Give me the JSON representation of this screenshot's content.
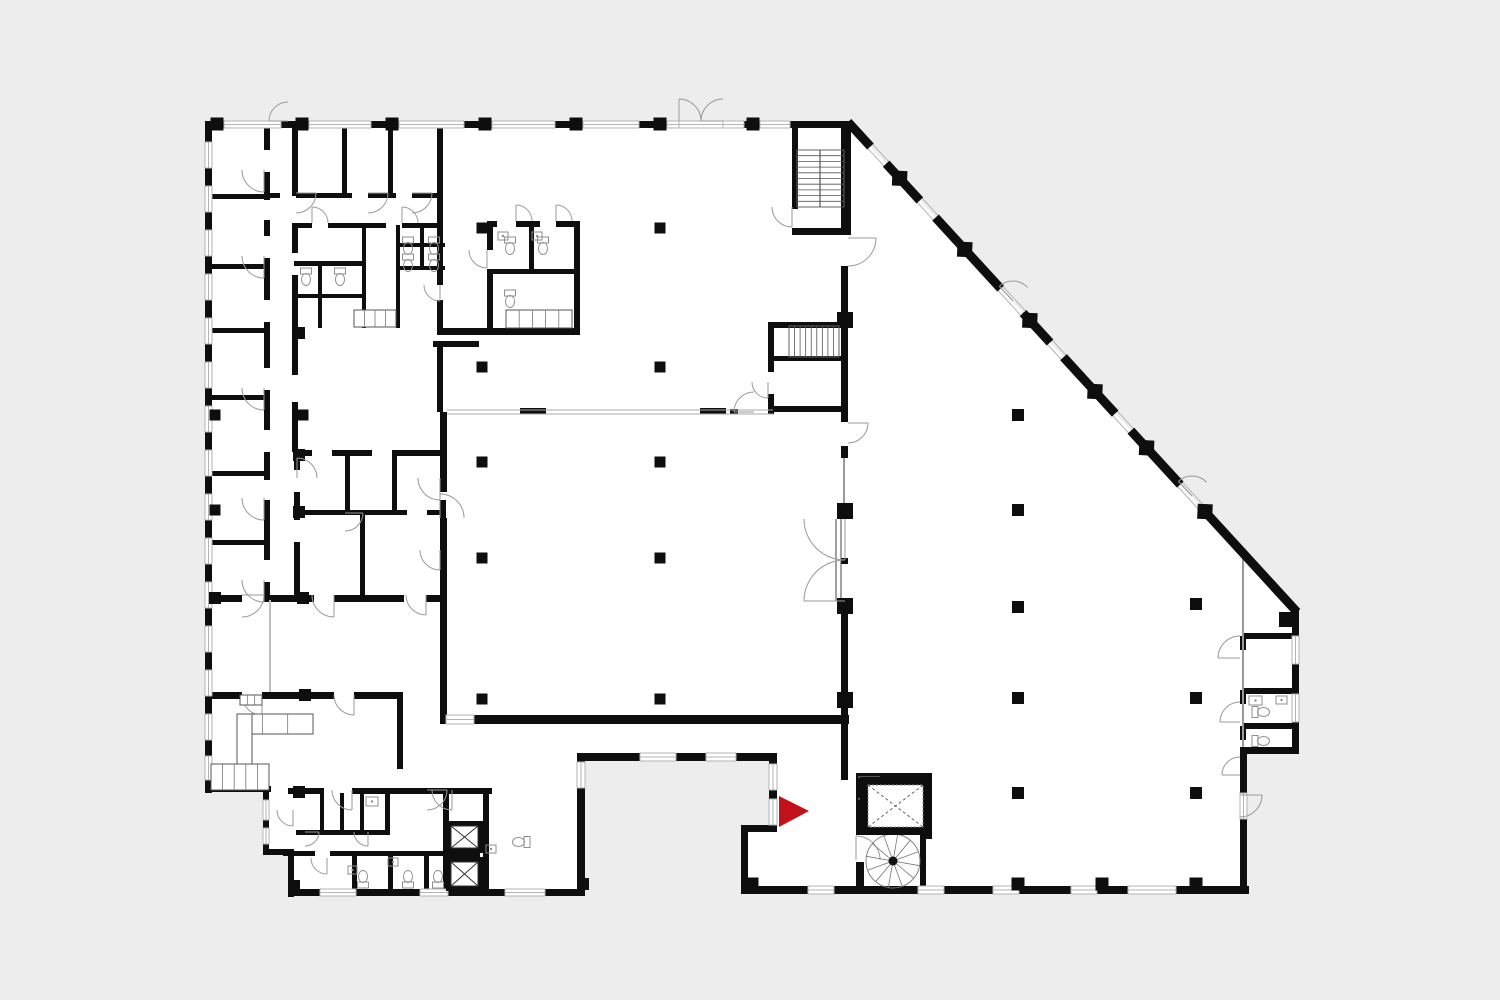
{
  "title": "building-floor-plan",
  "canvas": {
    "w": 1500,
    "h": 1000
  },
  "colors": {
    "bg": "#ededed",
    "floor": "#ffffff",
    "wall": "#0e0e0e",
    "thin": "#9a9a9a",
    "arc": "#9a9a9a",
    "fixture": "#8f8f8f",
    "window_edge": "#b3b3b3",
    "arrow": "#c1121c",
    "dash": "#666666"
  },
  "floor_outline": [
    [
      205,
      122
    ],
    [
      848,
      122
    ],
    [
      1297,
      612
    ],
    [
      1297,
      752
    ],
    [
      1247,
      752
    ],
    [
      1247,
      890
    ],
    [
      745,
      890
    ],
    [
      745,
      828
    ],
    [
      775,
      828
    ],
    [
      775,
      757
    ],
    [
      583,
      757
    ],
    [
      583,
      893
    ],
    [
      290,
      893
    ],
    [
      290,
      851
    ],
    [
      267,
      851
    ],
    [
      267,
      790
    ],
    [
      205,
      790
    ]
  ],
  "walls": [
    [
      205,
      121,
      645,
      7
    ],
    [
      205,
      121,
      7,
      672
    ],
    [
      205,
      786,
      66,
      6
    ],
    [
      263,
      786,
      6,
      69
    ],
    [
      263,
      849,
      31,
      6
    ],
    [
      288,
      849,
      6,
      48
    ],
    [
      288,
      889,
      297,
      7
    ],
    [
      577,
      753,
      8,
      142
    ],
    [
      577,
      753,
      200,
      8
    ],
    [
      769,
      753,
      8,
      79
    ],
    [
      741,
      825,
      36,
      7
    ],
    [
      741,
      825,
      7,
      68
    ],
    [
      741,
      886,
      508,
      8
    ],
    [
      1240,
      747,
      59,
      7
    ],
    [
      1240,
      747,
      7,
      147
    ],
    [
      1292,
      608,
      7,
      146
    ],
    [
      1243,
      633,
      52,
      6
    ],
    [
      1243,
      688,
      52,
      6
    ],
    [
      1243,
      723,
      52,
      6
    ],
    [
      1279,
      612,
      18,
      15
    ],
    [
      1240,
      636,
      6,
      14
    ],
    [
      1240,
      690,
      6,
      14
    ],
    [
      1240,
      726,
      6,
      14
    ],
    [
      841,
      121,
      10,
      112
    ],
    [
      841,
      266,
      7,
      52
    ],
    [
      841,
      326,
      7,
      86
    ],
    [
      841,
      412,
      7,
      10
    ],
    [
      841,
      446,
      7,
      12
    ],
    [
      841,
      558,
      7,
      6
    ],
    [
      841,
      612,
      7,
      148
    ],
    [
      841,
      760,
      7,
      20
    ],
    [
      792,
      121,
      6,
      88
    ],
    [
      792,
      228,
      59,
      7
    ],
    [
      768,
      322,
      77,
      6
    ],
    [
      768,
      322,
      6,
      50
    ],
    [
      768,
      356,
      77,
      5
    ],
    [
      768,
      394,
      6,
      20
    ],
    [
      768,
      406,
      77,
      6
    ],
    [
      520,
      408,
      26,
      6
    ],
    [
      700,
      408,
      26,
      6
    ],
    [
      730,
      409,
      8,
      5
    ],
    [
      440,
      412,
      7,
      80
    ],
    [
      440,
      518,
      7,
      204
    ],
    [
      440,
      715,
      409,
      9
    ],
    [
      437,
      127,
      6,
      133
    ],
    [
      437,
      260,
      6,
      25
    ],
    [
      437,
      300,
      6,
      30
    ],
    [
      433,
      341,
      46,
      6
    ],
    [
      437,
      341,
      6,
      71
    ],
    [
      437,
      328,
      143,
      7
    ],
    [
      487,
      221,
      10,
      6
    ],
    [
      516,
      221,
      24,
      6
    ],
    [
      556,
      221,
      24,
      6
    ],
    [
      487,
      221,
      6,
      29
    ],
    [
      487,
      270,
      6,
      60
    ],
    [
      574,
      221,
      6,
      109
    ],
    [
      487,
      269,
      93,
      5
    ],
    [
      529,
      221,
      5,
      48
    ],
    [
      264,
      121,
      6,
      29
    ],
    [
      264,
      172,
      6,
      28
    ],
    [
      264,
      220,
      6,
      16
    ],
    [
      264,
      258,
      6,
      42
    ],
    [
      264,
      322,
      6,
      46
    ],
    [
      264,
      390,
      6,
      40
    ],
    [
      264,
      452,
      6,
      28
    ],
    [
      264,
      500,
      6,
      60
    ],
    [
      264,
      582,
      6,
      16
    ],
    [
      292,
      121,
      6,
      75
    ],
    [
      292,
      223,
      6,
      30
    ],
    [
      292,
      275,
      6,
      55
    ],
    [
      292,
      330,
      6,
      45
    ],
    [
      292,
      402,
      6,
      50
    ],
    [
      342,
      127,
      5,
      68
    ],
    [
      388,
      127,
      5,
      68
    ],
    [
      267,
      193,
      13,
      5
    ],
    [
      296,
      193,
      56,
      5
    ],
    [
      368,
      193,
      28,
      5
    ],
    [
      412,
      193,
      28,
      5
    ],
    [
      294,
      223,
      18,
      5
    ],
    [
      328,
      223,
      58,
      5
    ],
    [
      402,
      223,
      38,
      5
    ],
    [
      318,
      261,
      4,
      67
    ],
    [
      294,
      261,
      72,
      5
    ],
    [
      294,
      294,
      72,
      4
    ],
    [
      362,
      225,
      4,
      103
    ],
    [
      396,
      225,
      4,
      103
    ],
    [
      396,
      243,
      49,
      4
    ],
    [
      396,
      266,
      49,
      4
    ],
    [
      420,
      225,
      4,
      42
    ],
    [
      205,
      194,
      62,
      5
    ],
    [
      205,
      264,
      62,
      5
    ],
    [
      205,
      328,
      62,
      5
    ],
    [
      205,
      395,
      62,
      5
    ],
    [
      205,
      471,
      62,
      5
    ],
    [
      205,
      540,
      62,
      5
    ],
    [
      205,
      595,
      37,
      7
    ],
    [
      264,
      595,
      50,
      7
    ],
    [
      334,
      595,
      70,
      7
    ],
    [
      426,
      595,
      19,
      7
    ],
    [
      294,
      450,
      18,
      6
    ],
    [
      332,
      450,
      40,
      6
    ],
    [
      392,
      450,
      53,
      6
    ],
    [
      440,
      450,
      6,
      26
    ],
    [
      440,
      500,
      6,
      30
    ],
    [
      440,
      552,
      6,
      45
    ],
    [
      294,
      452,
      6,
      18
    ],
    [
      294,
      492,
      6,
      28
    ],
    [
      294,
      542,
      6,
      55
    ],
    [
      345,
      452,
      5,
      60
    ],
    [
      392,
      452,
      5,
      60
    ],
    [
      294,
      510,
      113,
      5
    ],
    [
      427,
      510,
      18,
      5
    ],
    [
      360,
      515,
      5,
      82
    ],
    [
      205,
      692,
      37,
      7
    ],
    [
      262,
      692,
      72,
      7
    ],
    [
      354,
      692,
      49,
      7
    ],
    [
      397,
      692,
      6,
      77
    ],
    [
      288,
      788,
      36,
      6
    ],
    [
      352,
      788,
      95,
      6
    ],
    [
      443,
      788,
      49,
      6
    ],
    [
      320,
      793,
      4,
      39
    ],
    [
      340,
      793,
      4,
      39
    ],
    [
      360,
      793,
      4,
      39
    ],
    [
      385,
      793,
      5,
      39
    ],
    [
      296,
      830,
      94,
      5
    ],
    [
      283,
      851,
      32,
      5
    ],
    [
      330,
      851,
      117,
      5
    ],
    [
      352,
      856,
      5,
      37
    ],
    [
      388,
      856,
      5,
      37
    ],
    [
      424,
      856,
      5,
      37
    ],
    [
      443,
      788,
      6,
      105
    ],
    [
      483,
      788,
      6,
      105
    ],
    [
      449,
      852,
      31,
      5
    ],
    [
      856,
      773,
      8,
      62
    ],
    [
      856,
      862,
      8,
      31
    ],
    [
      856,
      773,
      76,
      8
    ],
    [
      926,
      773,
      6,
      66
    ],
    [
      920,
      833,
      6,
      57
    ]
  ],
  "windows": [
    [
      224,
      121,
      57,
      7
    ],
    [
      309,
      121,
      62,
      7
    ],
    [
      399,
      121,
      65,
      7
    ],
    [
      492,
      121,
      63,
      7
    ],
    [
      583,
      121,
      56,
      7
    ],
    [
      667,
      121,
      12,
      7
    ],
    [
      679,
      121,
      44,
      7
    ],
    [
      723,
      121,
      21,
      7
    ],
    [
      760,
      121,
      30,
      7
    ],
    [
      205,
      142,
      7,
      26
    ],
    [
      205,
      186,
      7,
      26
    ],
    [
      205,
      230,
      7,
      26
    ],
    [
      205,
      274,
      7,
      26
    ],
    [
      205,
      318,
      7,
      26
    ],
    [
      205,
      362,
      7,
      26
    ],
    [
      205,
      406,
      7,
      26
    ],
    [
      205,
      450,
      7,
      26
    ],
    [
      205,
      494,
      7,
      26
    ],
    [
      205,
      538,
      7,
      26
    ],
    [
      205,
      582,
      7,
      26
    ],
    [
      205,
      626,
      7,
      26
    ],
    [
      205,
      670,
      7,
      26
    ],
    [
      205,
      714,
      7,
      26
    ],
    [
      205,
      756,
      7,
      24
    ],
    [
      263,
      800,
      6,
      20
    ],
    [
      263,
      828,
      6,
      16
    ],
    [
      320,
      889,
      36,
      7
    ],
    [
      420,
      889,
      28,
      7
    ],
    [
      505,
      889,
      40,
      7
    ],
    [
      577,
      762,
      8,
      26
    ],
    [
      640,
      753,
      36,
      8
    ],
    [
      706,
      753,
      30,
      8
    ],
    [
      769,
      764,
      8,
      26
    ],
    [
      769,
      799,
      8,
      26
    ],
    [
      446,
      715,
      28,
      9
    ],
    [
      808,
      886,
      26,
      8
    ],
    [
      918,
      886,
      26,
      8
    ],
    [
      993,
      886,
      26,
      8
    ],
    [
      1071,
      886,
      26,
      8
    ],
    [
      1128,
      886,
      48,
      8
    ],
    [
      1292,
      636,
      7,
      28
    ],
    [
      1292,
      694,
      7,
      28
    ],
    [
      1240,
      793,
      7,
      26
    ]
  ],
  "thin_lines": [
    [
      447,
      410,
      773,
      410,
      1,
      "#aaaaaa"
    ],
    [
      447,
      414,
      773,
      414,
      1,
      "#aaaaaa"
    ],
    [
      1243,
      556,
      1243,
      747,
      2,
      "#9a9a9a"
    ],
    [
      270,
      600,
      270,
      692,
      2,
      "#c0c0c0"
    ],
    [
      844,
      458,
      844,
      508,
      2,
      "#9a9a9a"
    ],
    [
      820,
      150,
      820,
      207,
      1.2,
      "#555555"
    ],
    [
      836,
      519,
      836,
      601,
      1,
      "#444444"
    ],
    [
      841,
      519,
      841,
      601,
      1,
      "#444444"
    ]
  ],
  "diagonal": {
    "x1": 848,
    "y1": 122,
    "x2": 1297,
    "y2": 612,
    "width": 9,
    "black_segments": [
      [
        0,
        0.05
      ],
      [
        0.085,
        0.16
      ],
      [
        0.195,
        0.34
      ],
      [
        0.39,
        0.45
      ],
      [
        0.48,
        0.595
      ],
      [
        0.63,
        0.74
      ],
      [
        0.79,
        1.0
      ]
    ],
    "diamonds": [
      0.115,
      0.26,
      0.405,
      0.55,
      0.665,
      0.795
    ],
    "diamond_size": 15
  },
  "door_arcs": [
    [
      288,
      121,
      19,
      180,
      270
    ],
    [
      679,
      121,
      22,
      270,
      360
    ],
    [
      723,
      121,
      22,
      180,
      270
    ],
    [
      1013,
      301,
      20,
      -133,
      -43
    ],
    [
      1192,
      496,
      20,
      -133,
      -43
    ],
    [
      848,
      238,
      28,
      0,
      90
    ],
    [
      848,
      423,
      20,
      0,
      90
    ],
    [
      845,
      519,
      41,
      90,
      180
    ],
    [
      845,
      601,
      41,
      180,
      270
    ],
    [
      792,
      207,
      20,
      90,
      180
    ],
    [
      768,
      382,
      16,
      90,
      180
    ],
    [
      754,
      412,
      20,
      180,
      270
    ],
    [
      440,
      285,
      16,
      90,
      180
    ],
    [
      440,
      518,
      24,
      270,
      360
    ],
    [
      264,
      170,
      22,
      90,
      180
    ],
    [
      264,
      256,
      22,
      90,
      180
    ],
    [
      264,
      388,
      22,
      90,
      180
    ],
    [
      264,
      498,
      22,
      90,
      180
    ],
    [
      264,
      580,
      22,
      90,
      180
    ],
    [
      242,
      595,
      22,
      0,
      90
    ],
    [
      334,
      595,
      22,
      90,
      180
    ],
    [
      426,
      595,
      20,
      90,
      180
    ],
    [
      262,
      695,
      20,
      90,
      180
    ],
    [
      354,
      695,
      20,
      90,
      180
    ],
    [
      297,
      478,
      20,
      270,
      360
    ],
    [
      345,
      513,
      18,
      0,
      90
    ],
    [
      440,
      478,
      22,
      90,
      180
    ],
    [
      440,
      550,
      20,
      90,
      180
    ],
    [
      312,
      223,
      16,
      270,
      360
    ],
    [
      402,
      223,
      16,
      270,
      360
    ],
    [
      516,
      221,
      16,
      270,
      360
    ],
    [
      556,
      221,
      16,
      270,
      360
    ],
    [
      487,
      250,
      18,
      90,
      180
    ],
    [
      296,
      193,
      20,
      0,
      90
    ],
    [
      368,
      193,
      20,
      0,
      90
    ],
    [
      412,
      193,
      20,
      0,
      90
    ],
    [
      1240,
      658,
      22,
      180,
      270
    ],
    [
      1240,
      722,
      20,
      180,
      270
    ],
    [
      1240,
      775,
      18,
      180,
      270
    ],
    [
      1240,
      795,
      22,
      0,
      90
    ],
    [
      352,
      790,
      20,
      90,
      180
    ],
    [
      427,
      790,
      20,
      0,
      90
    ],
    [
      452,
      790,
      20,
      90,
      180
    ],
    [
      327,
      858,
      16,
      90,
      180
    ],
    [
      293,
      810,
      16,
      90,
      180
    ],
    [
      305,
      832,
      14,
      0,
      90
    ],
    [
      368,
      832,
      14,
      90,
      180
    ],
    [
      856,
      860,
      24,
      270,
      360
    ],
    [
      858,
      777,
      22,
      0,
      90
    ]
  ],
  "columns": [
    [
      217,
      124,
      13
    ],
    [
      302,
      124,
      13
    ],
    [
      392,
      124,
      13
    ],
    [
      485,
      124,
      13
    ],
    [
      576,
      124,
      13
    ],
    [
      660,
      124,
      13
    ],
    [
      753,
      124,
      13
    ],
    [
      482,
      228,
      11
    ],
    [
      660,
      228,
      11
    ],
    [
      482,
      367,
      11
    ],
    [
      660,
      367,
      11
    ],
    [
      482,
      462,
      11
    ],
    [
      660,
      462,
      11
    ],
    [
      482,
      558,
      11
    ],
    [
      660,
      558,
      11
    ],
    [
      482,
      699,
      11
    ],
    [
      660,
      699,
      11
    ],
    [
      215,
      415,
      11
    ],
    [
      303,
      415,
      11
    ],
    [
      215,
      510,
      11
    ],
    [
      215,
      598,
      12
    ],
    [
      303,
      598,
      12
    ],
    [
      299,
      333,
      12
    ],
    [
      299,
      455,
      12
    ],
    [
      299,
      512,
      12
    ],
    [
      305,
      695,
      12
    ],
    [
      299,
      792,
      12
    ],
    [
      1018,
      415,
      12
    ],
    [
      1018,
      510,
      12
    ],
    [
      1018,
      607,
      12
    ],
    [
      1018,
      698,
      12
    ],
    [
      1018,
      793,
      12
    ],
    [
      1196,
      604,
      12
    ],
    [
      1196,
      698,
      12
    ],
    [
      1196,
      793,
      12
    ],
    [
      845,
      320,
      16
    ],
    [
      845,
      511,
      16
    ],
    [
      845,
      606,
      16
    ],
    [
      845,
      700,
      16
    ],
    [
      752,
      884,
      13
    ],
    [
      1018,
      884,
      13
    ],
    [
      1102,
      884,
      13
    ],
    [
      1196,
      884,
      13
    ],
    [
      294,
      886,
      12
    ],
    [
      583,
      884,
      12
    ]
  ],
  "stairs": [
    {
      "x": 797,
      "y": 150,
      "w": 47,
      "h": 57,
      "n": 10,
      "dir": "h"
    },
    {
      "x": 789,
      "y": 326,
      "w": 50,
      "h": 31,
      "n": 9,
      "dir": "v"
    }
  ],
  "spiral": {
    "cx": 893,
    "cy": 861,
    "r": 27,
    "spokes": 12
  },
  "elevators": [
    {
      "x": 860,
      "y": 777,
      "w": 71,
      "h": 58,
      "inset": 8,
      "dashed": true
    },
    {
      "x": 446,
      "y": 821,
      "w": 37,
      "h": 32,
      "inset": 5,
      "dashed": false
    },
    {
      "x": 446,
      "y": 857,
      "w": 37,
      "h": 34,
      "inset": 5,
      "dashed": false
    }
  ],
  "toilets": [
    [
      306,
      278,
      0
    ],
    [
      340,
      278,
      0
    ],
    [
      408,
      247,
      0
    ],
    [
      434,
      247,
      0
    ],
    [
      408,
      264,
      0
    ],
    [
      434,
      264,
      0
    ],
    [
      510,
      247,
      0
    ],
    [
      543,
      247,
      0
    ],
    [
      510,
      300,
      0
    ],
    [
      363,
      878,
      180
    ],
    [
      408,
      878,
      180
    ],
    [
      438,
      878,
      180
    ],
    [
      520,
      842,
      90
    ],
    [
      1262,
      712,
      270
    ],
    [
      1262,
      741,
      270
    ]
  ],
  "sinks": [
    [
      366,
      797,
      12,
      9
    ],
    [
      388,
      858,
      10,
      8
    ],
    [
      486,
      845,
      10,
      8
    ],
    [
      348,
      866,
      9,
      8
    ],
    [
      1249,
      696,
      13,
      9
    ],
    [
      1276,
      696,
      11,
      8
    ],
    [
      498,
      232,
      10,
      8
    ],
    [
      532,
      232,
      10,
      8
    ]
  ],
  "counters": [
    {
      "x": 237,
      "y": 714,
      "w": 76,
      "h": 20,
      "ticks": 2
    },
    {
      "x": 237,
      "y": 714,
      "w": 15,
      "h": 52,
      "ticks": 0
    },
    {
      "x": 211,
      "y": 764,
      "w": 58,
      "h": 26,
      "ticks": 4
    },
    {
      "x": 506,
      "y": 310,
      "w": 66,
      "h": 18,
      "ticks": 4
    },
    {
      "x": 354,
      "y": 310,
      "w": 42,
      "h": 17,
      "ticks": 3
    },
    {
      "x": 240,
      "y": 695,
      "w": 22,
      "h": 10,
      "ticks": 2
    }
  ],
  "entrance_arrow": {
    "points": [
      [
        779,
        796
      ],
      [
        779,
        827
      ],
      [
        809,
        811
      ]
    ],
    "color": "#c1121c"
  }
}
